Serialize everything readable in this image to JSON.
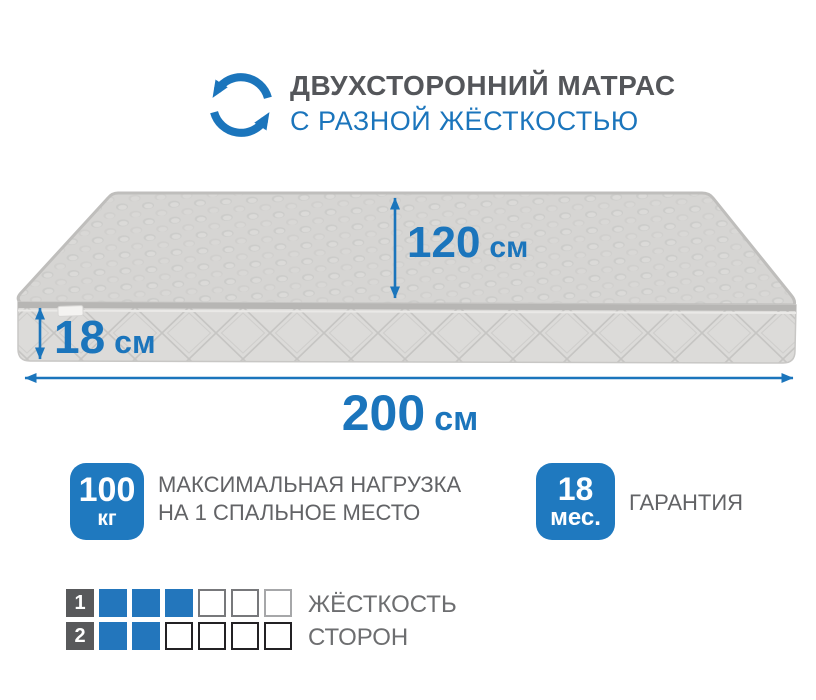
{
  "header": {
    "title": "ДВУХСТОРОННИЙ МАТРАС",
    "subtitle": "С РАЗНОЙ ЖЁСТКОСТЬЮ",
    "icon": "rotate-arrows-icon"
  },
  "dimensions": {
    "depth": {
      "value": "120",
      "unit": "см"
    },
    "height": {
      "value": "18",
      "unit": "см"
    },
    "width": {
      "value": "200",
      "unit": "см"
    }
  },
  "badges": [
    {
      "value": "100",
      "unit": "кг",
      "label_lines": [
        "МАКСИМАЛЬНАЯ НАГРУЗКА",
        "НА 1 СПАЛЬНОЕ МЕСТО"
      ]
    },
    {
      "value": "18",
      "unit": "мес.",
      "label_lines": [
        "ГАРАНТИЯ"
      ]
    }
  ],
  "hardness": {
    "rows": [
      {
        "label": "1",
        "filled": 3,
        "total": 6
      },
      {
        "label": "2",
        "filled": 2,
        "total": 6
      }
    ],
    "caption_line1": "ЖЁСТКОСТЬ",
    "caption_line2": "СТОРОН"
  },
  "colors": {
    "accent_blue": "#1b75bc",
    "badge_blue": "#1f79bf",
    "square_blue": "#2376bc",
    "title_gray": "#54565a",
    "text_gray": "#6d6e70",
    "mattress_top": "#d6d5d3",
    "mattress_front": "#dcdbd9"
  }
}
